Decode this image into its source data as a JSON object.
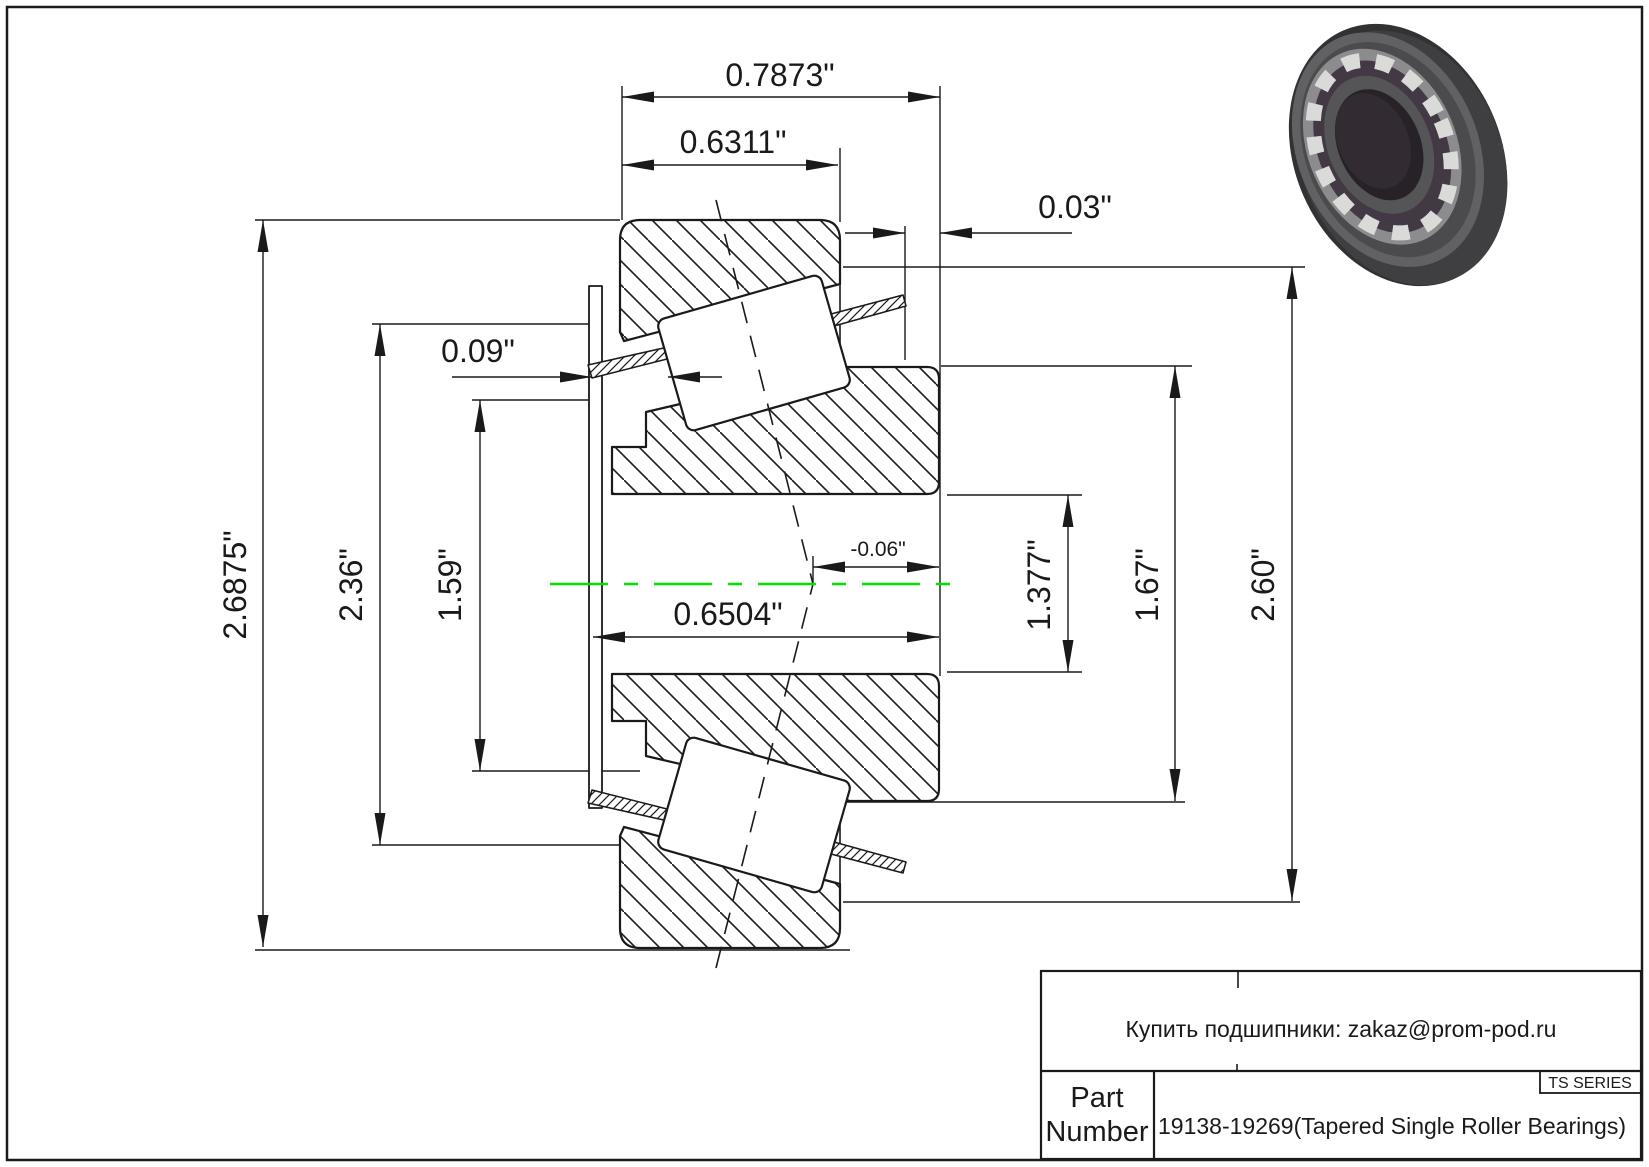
{
  "sheet": {
    "kind": "Tapered roller bearing engineering drawing"
  },
  "dimensions": {
    "overall_width": "0.7873\"",
    "cup_width": "0.6311\"",
    "cage_stickout_back": "0.03\"",
    "cage_stickout_front": "0.09\"",
    "housing_od": "2.6875\"",
    "flange_od": "2.36\"",
    "race_od": "1.59\"",
    "center_width": "0.6504\"",
    "effective_center": "-0.06\"",
    "bore_diameter": "1.377\"",
    "cone_front_od": "1.67\"",
    "cup_od": "2.60\""
  },
  "title_block": {
    "contact": "Купить подшипники: zakaz@prom-pod.ru",
    "series_label": "TS SERIES",
    "part_label_line1": "Part",
    "part_label_line2": "Number",
    "part_number": "19138-19269(Tapered Single Roller Bearings)"
  },
  "colors": {
    "centerline_green": "#00E100",
    "line_black": "#1A1A1A",
    "ring_3d_dark": "#323234",
    "roller_3d_light": "#DADAD8"
  }
}
